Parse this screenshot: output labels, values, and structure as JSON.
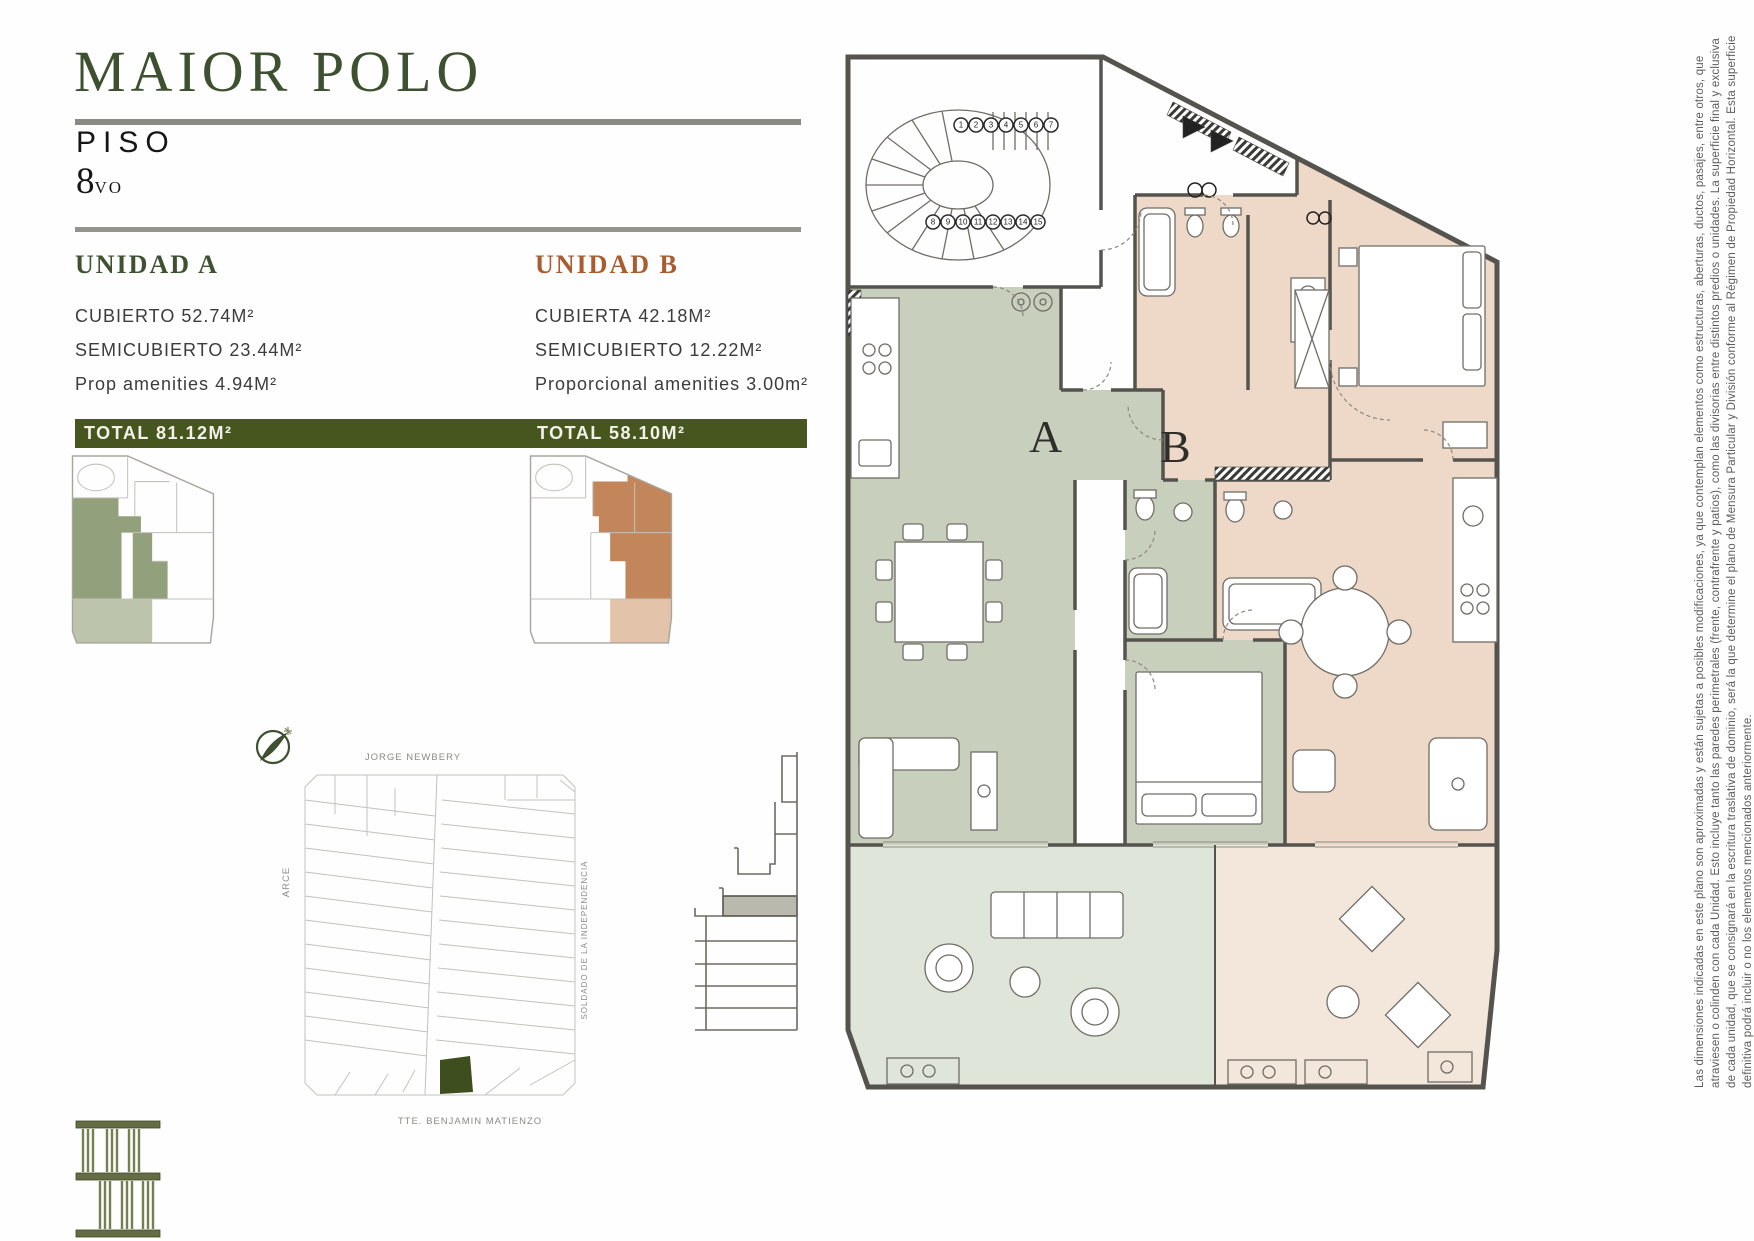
{
  "header": {
    "title": "MAIOR POLO",
    "floor_label": "PISO",
    "floor_number": "8",
    "floor_ordinal_suffix": "VO"
  },
  "units": [
    {
      "id": "A",
      "name": "UNIDAD A",
      "plan_letter": "A",
      "areas": [
        {
          "label": "CUBIERTO",
          "value": "52.74M²"
        },
        {
          "label": "SEMICUBIERTO",
          "value": "23.44M²"
        },
        {
          "label": "Prop amenities",
          "value": "4.94M²"
        }
      ],
      "total_label": "TOTAL 81.12M²"
    },
    {
      "id": "B",
      "name": "UNIDAD B",
      "plan_letter": "B",
      "areas": [
        {
          "label": "CUBIERTA",
          "value": "42.18M²"
        },
        {
          "label": "SEMICUBIERTO",
          "value": "12.22M²"
        },
        {
          "label": "Proporcional amenities",
          "value": "3.00m²"
        }
      ],
      "total_label": "TOTAL 58.10M²"
    }
  ],
  "map": {
    "street_top": "JORGE NEWBERY",
    "street_left": "ARCE",
    "street_right": "SOLDADO DE LA INDEPENDENCIA",
    "street_bottom": "TTE. BENJAMIN MATIENZO"
  },
  "plan": {
    "unit_a_letter": "A",
    "unit_b_letter": "B",
    "stair_step_rows": [
      [
        "1",
        "2",
        "3",
        "4",
        "5",
        "6",
        "7"
      ],
      [
        "8",
        "9",
        "10",
        "11",
        "12",
        "13",
        "14",
        "15"
      ]
    ]
  },
  "disclaimer_lines": [
    "Las dimensiones indicadas en este plano son aproximadas y están sujetas a posibles modificaciones, ya que contemplan elementos como estructuras, aberturas, ductos, pasajes, entre otros, que",
    "atraviesen o colinden con cada Unidad. Esto incluye tanto las paredes perimetrales (frente, contrafrente y patios), como las divisorias entre distintos predios o unidades. La superficie final y exclusiva",
    "de cada unidad, que se consignará en la escritura traslativa de dominio, será la que determine el plano de Mensura Particular y División conforme al Régimen de Propiedad Horizontal. Esta superficie",
    "definitiva podrá incluir o no los elementos mencionados anteriormente."
  ],
  "colors": {
    "title_green": "#3d5130",
    "unit_b_heading": "#a85c2f",
    "total_bar_green": "#47561f",
    "unit_a_fill": "#c9cfbd",
    "unit_b_fill": "#eed9c9",
    "terrace_a_fill": "#dfe5d8",
    "terrace_b_fill": "#f3e6db",
    "thumb_a_green": "#93a07c",
    "thumb_b_tan": "#c2865a",
    "wall_gray": "#55534d",
    "map_parcel_green": "#3f4e1e"
  }
}
